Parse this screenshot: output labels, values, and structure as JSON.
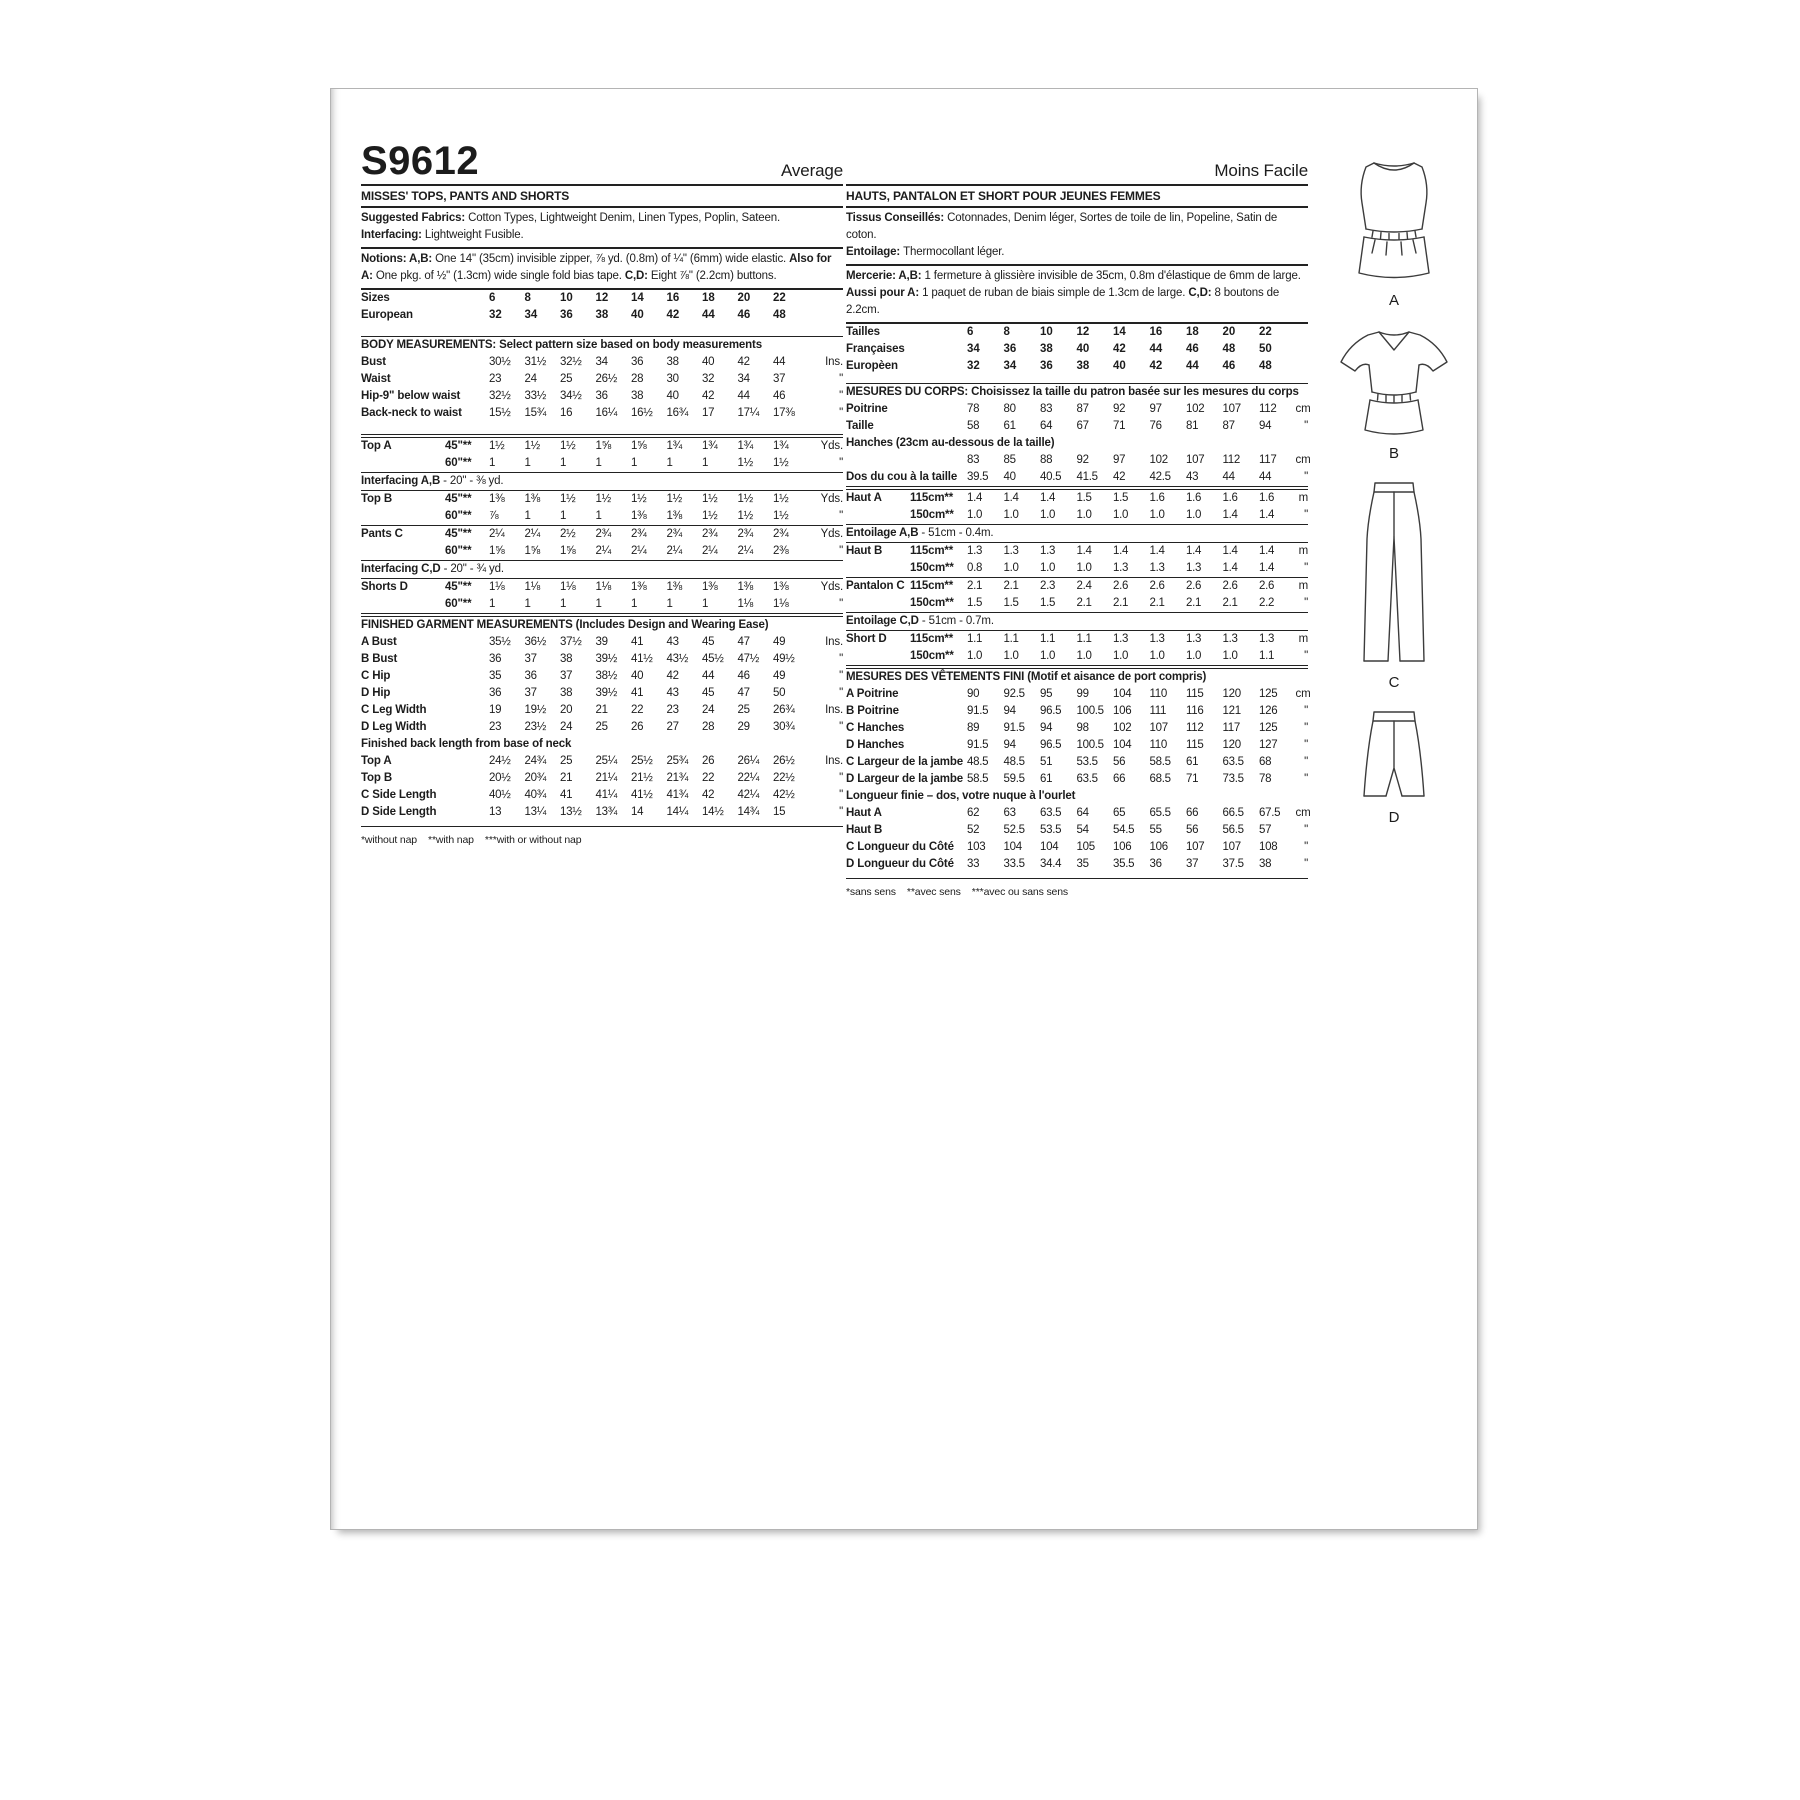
{
  "meta": {
    "sku": "S9612",
    "difficulty_en": "Average",
    "difficulty_fr": "Moins Facile"
  },
  "english": {
    "title": "MISSES' TOPS, PANTS AND SHORTS",
    "fabrics": [
      {
        "b": "Suggested Fabrics: "
      },
      {
        "t": "Cotton Types, Lightweight Denim, Linen Types, Poplin, Sateen. "
      },
      {
        "b": "Interfacing: "
      },
      {
        "t": "Lightweight Fusible."
      }
    ],
    "notions": [
      {
        "b": "Notions: A,B: "
      },
      {
        "t": "One 14\" (35cm) invisible zipper, ⅞ yd. (0.8m) of ¼\" (6mm) wide elastic. "
      },
      {
        "b": "Also for A: "
      },
      {
        "t": "One pkg. of ½\" (1.3cm) wide single fold bias tape. "
      },
      {
        "b": "C,D: "
      },
      {
        "t": "Eight ⅞\" (2.2cm) buttons."
      }
    ],
    "sizes": [
      {
        "label": "Sizes",
        "values": [
          "6",
          "8",
          "10",
          "12",
          "14",
          "16",
          "18",
          "20",
          "22"
        ],
        "unit": "",
        "cls": "bold"
      },
      {
        "label": "European",
        "values": [
          "32",
          "34",
          "36",
          "38",
          "40",
          "42",
          "44",
          "46",
          "48"
        ],
        "unit": "",
        "cls": "bold"
      }
    ],
    "body_header": "BODY MEASUREMENTS: Select pattern size based on body measurements",
    "body": [
      {
        "label": "Bust",
        "values": [
          "30½",
          "31½",
          "32½",
          "34",
          "36",
          "38",
          "40",
          "42",
          "44"
        ],
        "unit": "Ins."
      },
      {
        "label": "Waist",
        "values": [
          "23",
          "24",
          "25",
          "26½",
          "28",
          "30",
          "32",
          "34",
          "37"
        ],
        "unit": "\""
      },
      {
        "label": "Hip-9\" below waist",
        "values": [
          "32½",
          "33½",
          "34½",
          "36",
          "38",
          "40",
          "42",
          "44",
          "46"
        ],
        "unit": "\""
      },
      {
        "label": "Back-neck to waist",
        "values": [
          "15½",
          "15¾",
          "16",
          "16¼",
          "16½",
          "16¾",
          "17",
          "17¼",
          "17⅜"
        ],
        "unit": "\""
      }
    ],
    "top_a": [
      {
        "label": "Top A",
        "sub": "45\"**",
        "values": [
          "1½",
          "1½",
          "1½",
          "1⅝",
          "1⅝",
          "1¾",
          "1¾",
          "1¾",
          "1¾"
        ],
        "unit": "Yds."
      },
      {
        "label": "",
        "sub": "60\"**",
        "values": [
          "1",
          "1",
          "1",
          "1",
          "1",
          "1",
          "1",
          "1½",
          "1½"
        ],
        "unit": "\""
      }
    ],
    "interfacing_ab": [
      {
        "b": "Interfacing  A,B"
      },
      {
        "t": " - 20\" - ⅜ yd."
      }
    ],
    "top_b": [
      {
        "label": "Top B",
        "sub": "45\"**",
        "values": [
          "1⅜",
          "1⅜",
          "1½",
          "1½",
          "1½",
          "1½",
          "1½",
          "1½",
          "1½"
        ],
        "unit": "Yds."
      },
      {
        "label": "",
        "sub": "60\"**",
        "values": [
          "⅞",
          "1",
          "1",
          "1",
          "1⅜",
          "1⅜",
          "1½",
          "1½",
          "1½"
        ],
        "unit": "\""
      }
    ],
    "pants_c": [
      {
        "label": "Pants C",
        "sub": "45\"**",
        "values": [
          "2¼",
          "2¼",
          "2½",
          "2¾",
          "2¾",
          "2¾",
          "2¾",
          "2¾",
          "2¾"
        ],
        "unit": "Yds."
      },
      {
        "label": "",
        "sub": "60\"**",
        "values": [
          "1⅝",
          "1⅝",
          "1⅝",
          "2¼",
          "2¼",
          "2¼",
          "2¼",
          "2¼",
          "2⅜"
        ],
        "unit": "\""
      }
    ],
    "interfacing_cd": [
      {
        "b": "Interfacing C,D"
      },
      {
        "t": " - 20\" - ¾ yd."
      }
    ],
    "shorts_d": [
      {
        "label": "Shorts D",
        "sub": "45\"**",
        "values": [
          "1⅛",
          "1⅛",
          "1⅛",
          "1⅛",
          "1⅜",
          "1⅜",
          "1⅜",
          "1⅜",
          "1⅜"
        ],
        "unit": "Yds."
      },
      {
        "label": "",
        "sub": "60\"**",
        "values": [
          "1",
          "1",
          "1",
          "1",
          "1",
          "1",
          "1",
          "1⅛",
          "1⅛"
        ],
        "unit": "\""
      }
    ],
    "finished_header": "FINISHED GARMENT MEASUREMENTS (Includes Design and Wearing Ease)",
    "finished": [
      {
        "label": "A Bust",
        "values": [
          "35½",
          "36½",
          "37½",
          "39",
          "41",
          "43",
          "45",
          "47",
          "49"
        ],
        "unit": "Ins."
      },
      {
        "label": "B Bust",
        "values": [
          "36",
          "37",
          "38",
          "39½",
          "41½",
          "43½",
          "45½",
          "47½",
          "49½"
        ],
        "unit": "\""
      },
      {
        "label": "C Hip",
        "values": [
          "35",
          "36",
          "37",
          "38½",
          "40",
          "42",
          "44",
          "46",
          "49"
        ],
        "unit": "\""
      },
      {
        "label": "D Hip",
        "values": [
          "36",
          "37",
          "38",
          "39½",
          "41",
          "43",
          "45",
          "47",
          "50"
        ],
        "unit": "\""
      },
      {
        "label": "C Leg Width",
        "values": [
          "19",
          "19½",
          "20",
          "21",
          "22",
          "23",
          "24",
          "25",
          "26¾"
        ],
        "unit": "Ins."
      },
      {
        "label": "D Leg Width",
        "values": [
          "23",
          "23½",
          "24",
          "25",
          "26",
          "27",
          "28",
          "29",
          "30¾"
        ],
        "unit": "\""
      }
    ],
    "back_length_header": "Finished back length from base of neck",
    "back_length": [
      {
        "label": "Top A",
        "values": [
          "24½",
          "24¾",
          "25",
          "25¼",
          "25½",
          "25¾",
          "26",
          "26¼",
          "26½"
        ],
        "unit": "Ins."
      },
      {
        "label": "Top B",
        "values": [
          "20½",
          "20¾",
          "21",
          "21¼",
          "21½",
          "21¾",
          "22",
          "22¼",
          "22½"
        ],
        "unit": "\""
      },
      {
        "label": "C Side Length",
        "values": [
          "40½",
          "40¾",
          "41",
          "41¼",
          "41½",
          "41¾",
          "42",
          "42¼",
          "42½"
        ],
        "unit": "\""
      },
      {
        "label": "D Side Length",
        "values": [
          "13",
          "13¼",
          "13½",
          "13¾",
          "14",
          "14¼",
          "14½",
          "14¾",
          "15"
        ],
        "unit": "\""
      }
    ],
    "footnote": "*without nap    **with nap    ***with or without nap"
  },
  "french": {
    "title": "HAUTS, PANTALON ET SHORT POUR JEUNES FEMMES",
    "tissus": [
      {
        "b": "Tissus Conseillés: "
      },
      {
        "t": "Cotonnades, Denim léger, Sortes de toile de lin, Popeline, Satin de coton."
      }
    ],
    "entoilage_line": [
      {
        "b": "Entoilage: "
      },
      {
        "t": "Thermocollant léger."
      }
    ],
    "mercerie": [
      {
        "b": "Mercerie: A,B: "
      },
      {
        "t": "1 fermeture à glissière invisible de 35cm, 0.8m d'élastique de 6mm de large."
      }
    ],
    "aussi": [
      {
        "b": "Aussi pour A: "
      },
      {
        "t": "1 paquet de ruban de biais simple de 1.3cm de large. "
      },
      {
        "b": "C,D: "
      },
      {
        "t": "8 boutons de 2.2cm."
      }
    ],
    "sizes": [
      {
        "label": "Tailles",
        "values": [
          "6",
          "8",
          "10",
          "12",
          "14",
          "16",
          "18",
          "20",
          "22"
        ],
        "unit": "",
        "cls": "bold"
      },
      {
        "label": "Françaises",
        "values": [
          "34",
          "36",
          "38",
          "40",
          "42",
          "44",
          "46",
          "48",
          "50"
        ],
        "unit": "",
        "cls": "bold"
      },
      {
        "label": "Europèen",
        "values": [
          "32",
          "34",
          "36",
          "38",
          "40",
          "42",
          "44",
          "46",
          "48"
        ],
        "unit": "",
        "cls": "bold"
      }
    ],
    "mesures_header": "MESURES DU CORPS: Choisissez la taille du patron basée sur les mesures du corps",
    "body1": [
      {
        "label": "Poitrine",
        "values": [
          "78",
          "80",
          "83",
          "87",
          "92",
          "97",
          "102",
          "107",
          "112"
        ],
        "unit": "cm"
      },
      {
        "label": "Taille",
        "values": [
          "58",
          "61",
          "64",
          "67",
          "71",
          "76",
          "81",
          "87",
          "94"
        ],
        "unit": "\""
      }
    ],
    "hanches_header": "Hanches (23cm au-dessous de la taille)",
    "body2": [
      {
        "label": "",
        "values": [
          "83",
          "85",
          "88",
          "92",
          "97",
          "102",
          "107",
          "112",
          "117"
        ],
        "unit": "cm"
      },
      {
        "label": "Dos du cou à la taille",
        "values": [
          "39.5",
          "40",
          "40.5",
          "41.5",
          "42",
          "42.5",
          "43",
          "44",
          "44"
        ],
        "unit": "\""
      }
    ],
    "haut_a": [
      {
        "label": "Haut A",
        "sub": "115cm**",
        "values": [
          "1.4",
          "1.4",
          "1.4",
          "1.5",
          "1.5",
          "1.6",
          "1.6",
          "1.6",
          "1.6"
        ],
        "unit": "m"
      },
      {
        "label": "",
        "sub": "150cm**",
        "values": [
          "1.0",
          "1.0",
          "1.0",
          "1.0",
          "1.0",
          "1.0",
          "1.0",
          "1.4",
          "1.4"
        ],
        "unit": "\""
      }
    ],
    "entoilage_ab": [
      {
        "b": "Entoilage A,B"
      },
      {
        "t": " - 51cm - 0.4m."
      }
    ],
    "haut_b": [
      {
        "label": "Haut B",
        "sub": "115cm**",
        "values": [
          "1.3",
          "1.3",
          "1.3",
          "1.4",
          "1.4",
          "1.4",
          "1.4",
          "1.4",
          "1.4"
        ],
        "unit": "m"
      },
      {
        "label": "",
        "sub": "150cm**",
        "values": [
          "0.8",
          "1.0",
          "1.0",
          "1.0",
          "1.3",
          "1.3",
          "1.3",
          "1.4",
          "1.4"
        ],
        "unit": "\""
      }
    ],
    "pantalon_c": [
      {
        "label": "Pantalon C",
        "sub": "115cm**",
        "values": [
          "2.1",
          "2.1",
          "2.3",
          "2.4",
          "2.6",
          "2.6",
          "2.6",
          "2.6",
          "2.6"
        ],
        "unit": "m"
      },
      {
        "label": "",
        "sub": "150cm**",
        "values": [
          "1.5",
          "1.5",
          "1.5",
          "2.1",
          "2.1",
          "2.1",
          "2.1",
          "2.1",
          "2.2"
        ],
        "unit": "\""
      }
    ],
    "entoilage_cd": [
      {
        "b": "Entoilage C,D"
      },
      {
        "t": " - 51cm - 0.7m."
      }
    ],
    "short_d": [
      {
        "label": "Short D",
        "sub": "115cm**",
        "values": [
          "1.1",
          "1.1",
          "1.1",
          "1.1",
          "1.3",
          "1.3",
          "1.3",
          "1.3",
          "1.3"
        ],
        "unit": "m"
      },
      {
        "label": "",
        "sub": "150cm**",
        "values": [
          "1.0",
          "1.0",
          "1.0",
          "1.0",
          "1.0",
          "1.0",
          "1.0",
          "1.0",
          "1.1"
        ],
        "unit": "\""
      }
    ],
    "fini_header": "MESURES DES VÊTEMENTS FINI (Motif et aisance de port compris)",
    "fini1": [
      {
        "label": "A Poitrine",
        "values": [
          "90",
          "92.5",
          "95",
          "99",
          "104",
          "110",
          "115",
          "120",
          "125"
        ],
        "unit": "cm"
      },
      {
        "label": "B Poitrine",
        "values": [
          "91.5",
          "94",
          "96.5",
          "100.5",
          "106",
          "111",
          "116",
          "121",
          "126"
        ],
        "unit": "\""
      },
      {
        "label": "C Hanches",
        "values": [
          "89",
          "91.5",
          "94",
          "98",
          "102",
          "107",
          "112",
          "117",
          "125"
        ],
        "unit": "\""
      },
      {
        "label": "D Hanches",
        "values": [
          "91.5",
          "94",
          "96.5",
          "100.5",
          "104",
          "110",
          "115",
          "120",
          "127"
        ],
        "unit": "\""
      },
      {
        "label": "C Largeur de la jambe",
        "values": [
          "48.5",
          "48.5",
          "51",
          "53.5",
          "56",
          "58.5",
          "61",
          "63.5",
          "68"
        ],
        "unit": "\""
      },
      {
        "label": "D Largeur de la jambe",
        "values": [
          "58.5",
          "59.5",
          "61",
          "63.5",
          "66",
          "68.5",
          "71",
          "73.5",
          "78"
        ],
        "unit": "\""
      }
    ],
    "longueur_header": "Longueur finie – dos, votre nuque à l'ourlet",
    "fini2": [
      {
        "label": "Haut A",
        "values": [
          "62",
          "63",
          "63.5",
          "64",
          "65",
          "65.5",
          "66",
          "66.5",
          "67.5"
        ],
        "unit": "cm"
      },
      {
        "label": "Haut B",
        "values": [
          "52",
          "52.5",
          "53.5",
          "54",
          "54.5",
          "55",
          "56",
          "56.5",
          "57"
        ],
        "unit": "\""
      },
      {
        "label": "C Longueur du Côté",
        "values": [
          "103",
          "104",
          "104",
          "105",
          "106",
          "106",
          "107",
          "107",
          "108"
        ],
        "unit": "\""
      },
      {
        "label": "D Longueur du Côté",
        "values": [
          "33",
          "33.5",
          "34.4",
          "35",
          "35.5",
          "36",
          "37",
          "37.5",
          "38"
        ],
        "unit": "\""
      }
    ],
    "footnote": "*sans sens    **avec sens    ***avec ou sans sens"
  },
  "illustrations": [
    {
      "id": "A",
      "label": "A"
    },
    {
      "id": "B",
      "label": "B"
    },
    {
      "id": "C",
      "label": "C"
    },
    {
      "id": "D",
      "label": "D"
    }
  ]
}
